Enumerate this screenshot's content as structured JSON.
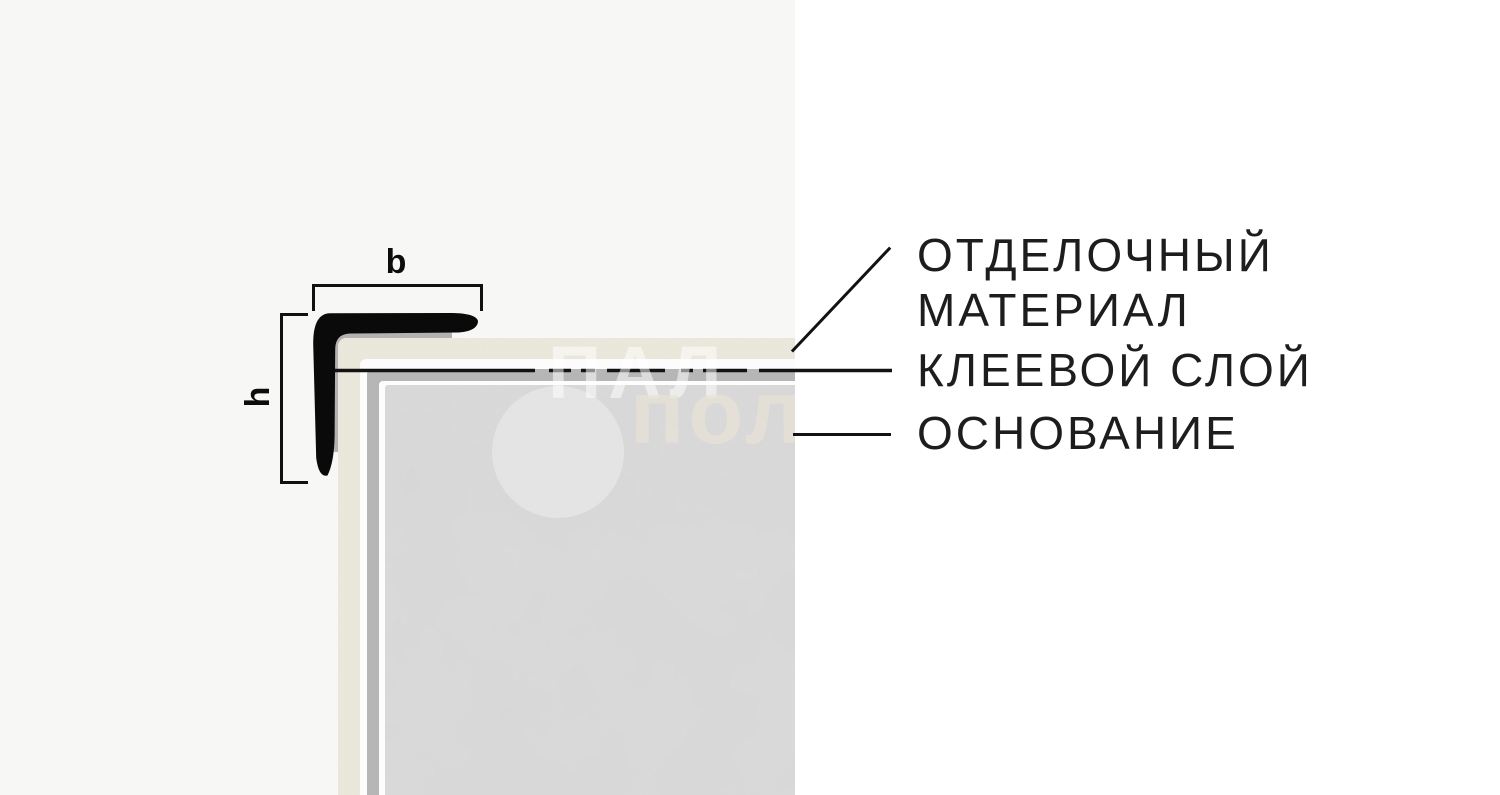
{
  "page": {
    "background": "#ffffff",
    "panel_background": "#f7f7f6",
    "text_color": "#1d1d1d",
    "line_color": "#121212"
  },
  "dimensions": {
    "width_label": "b",
    "height_label": "h"
  },
  "callouts": {
    "finishing": {
      "line1": "ОТДЕЛОЧНЫЙ",
      "line2": "МАТЕРИАЛ"
    },
    "adhesive": {
      "label": "КЛЕЕВОЙ СЛОЙ"
    },
    "base": {
      "label": "ОСНОВАНИЕ"
    }
  },
  "layers": {
    "profile": {
      "name": "corner-profile",
      "color": "#0a0a0a"
    },
    "profile_backing": {
      "name": "profile-backing",
      "color": "#b2b2b2"
    },
    "finishing_material": {
      "name": "finishing-material",
      "color": "#eceade"
    },
    "white_gap": {
      "name": "white-gap",
      "color": "#fcfcfc"
    },
    "adhesive_gray": {
      "name": "adhesive-layer",
      "color": "#b6b6b6"
    },
    "white_line": {
      "name": "thin-white-line",
      "color": "#fdfdfd"
    },
    "base_concrete": {
      "name": "base-substrate",
      "color": "#d9d9d9"
    }
  },
  "watermark": {
    "row1": "ПАЛ",
    "row2": "пол"
  }
}
